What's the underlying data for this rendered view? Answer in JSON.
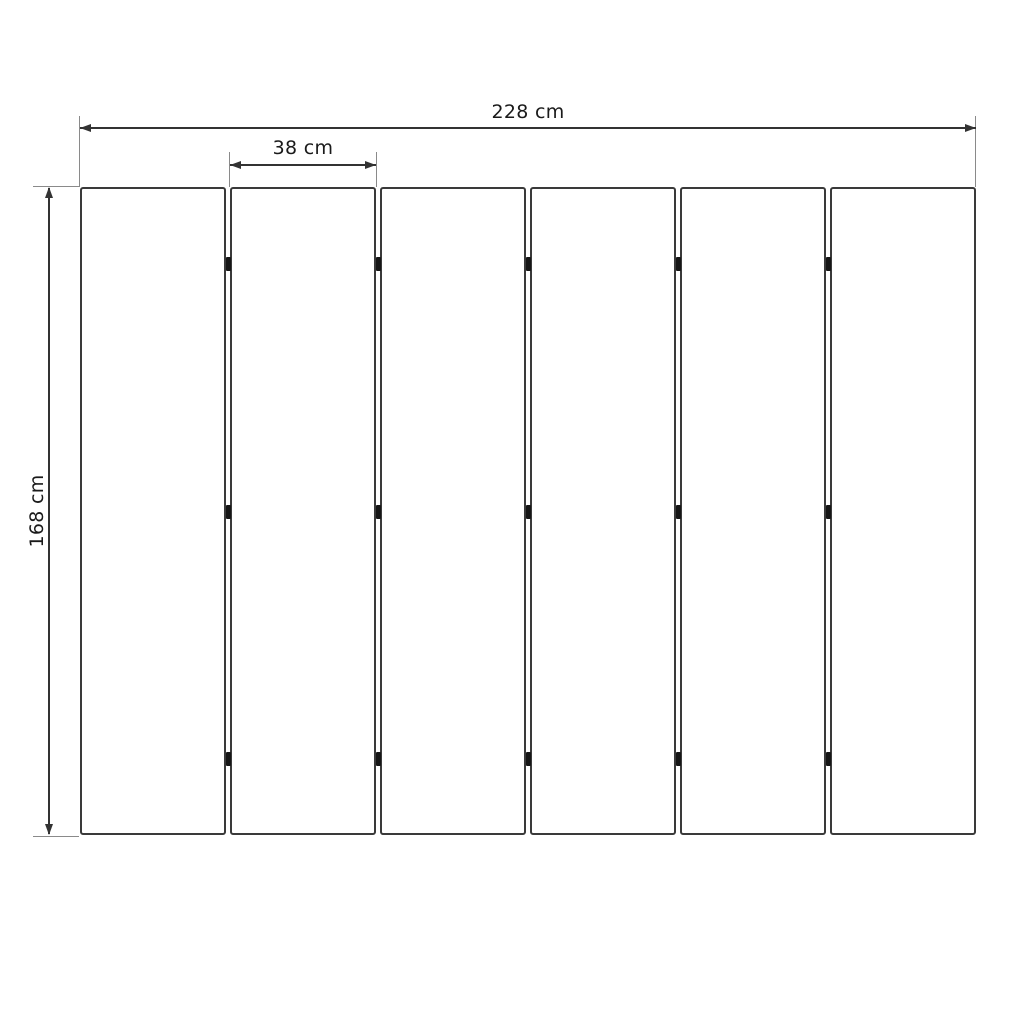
{
  "drawing": {
    "type": "panel-dimension-diagram",
    "background": "#ffffff",
    "dimensions": {
      "total_width": {
        "label": "228 cm"
      },
      "panel_width": {
        "label": "38 cm"
      },
      "panel_height": {
        "label": "168 cm"
      }
    },
    "panels": {
      "count": 6,
      "gaps": 5,
      "hinges_per_gap": 3
    },
    "colors": {
      "panel_border": "#3a3a3a",
      "dimension_line": "#333333",
      "extension_line": "#8a8a8a",
      "hinge": "#161616",
      "label_text": "#1a1a1a"
    }
  }
}
